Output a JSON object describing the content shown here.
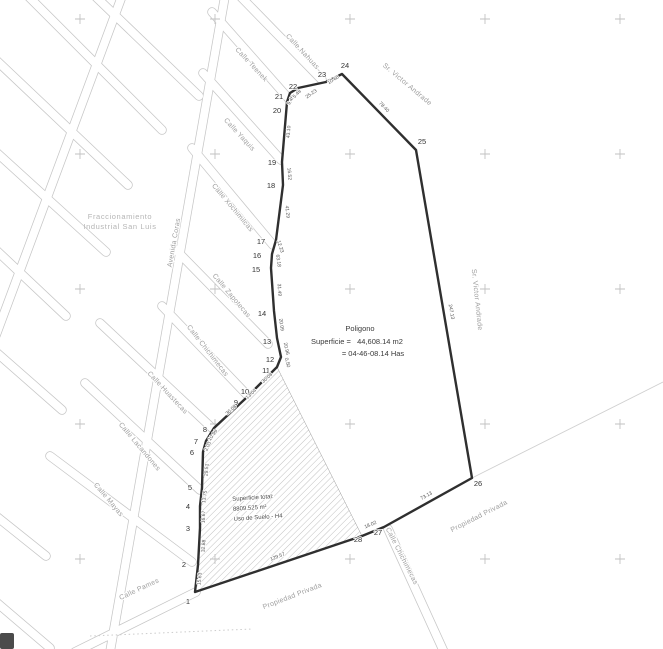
{
  "map": {
    "region_label": {
      "line1": "Fraccionamiento",
      "line2": "Industrial San Luis"
    },
    "center_note": {
      "title": "Poligono",
      "line2": "Superficie =   44,608.14 m2",
      "line3": "= 04-46-08.14 Has"
    },
    "hatch_note": {
      "line1": "Superficie total:",
      "line2": "8809.525 m²",
      "line3": "Uso de Suelo - H4"
    },
    "colors": {
      "boundary": "#2f2f2f",
      "streets": "#c6c6c6",
      "labels": "#9e9e9e",
      "crosses": "#c2c2c2"
    },
    "streets": [
      {
        "label": "Calle Nahuas",
        "x": 301,
        "y": 53,
        "rot": 47
      },
      {
        "label": "Calle Teenek",
        "x": 250,
        "y": 66,
        "rot": 47
      },
      {
        "label": "Calle Yaquis",
        "x": 238,
        "y": 136,
        "rot": 47
      },
      {
        "label": "Calle Xochimilcas",
        "x": 231,
        "y": 209,
        "rot": 50
      },
      {
        "label": "Calle Zapotecas",
        "x": 230,
        "y": 297,
        "rot": 50
      },
      {
        "label": "Calle Chichimecas",
        "x": 206,
        "y": 352,
        "rot": 52
      },
      {
        "label": "Calle Huastecas",
        "x": 166,
        "y": 394,
        "rot": 47
      },
      {
        "label": "Calle Lacandones",
        "x": 138,
        "y": 448,
        "rot": 50
      },
      {
        "label": "Calle Mayas",
        "x": 107,
        "y": 501,
        "rot": 50
      },
      {
        "label": "Calle Pames",
        "x": 140,
        "y": 591,
        "rot": -25
      },
      {
        "label": "Avenida Coras",
        "x": 176,
        "y": 243,
        "rot": -80
      },
      {
        "label": "Calle Chichimecas",
        "x": 400,
        "y": 557,
        "rot": 63
      }
    ],
    "annotations": [
      {
        "label": "Sr. Victor Andrade",
        "x": 406,
        "y": 86,
        "rot": 40
      },
      {
        "label": "Sr. Victor Andrade",
        "x": 475,
        "y": 300,
        "rot": 84
      },
      {
        "label": "Propiedad Privada",
        "x": 480,
        "y": 518,
        "rot": -27
      },
      {
        "label": "Propiedad Privada",
        "x": 293,
        "y": 598,
        "rot": -21
      }
    ],
    "polygon": {
      "vertices": [
        {
          "n": "1",
          "x": 188,
          "y": 604
        },
        {
          "n": "2",
          "x": 184,
          "y": 567
        },
        {
          "n": "3",
          "x": 188,
          "y": 531
        },
        {
          "n": "4",
          "x": 188,
          "y": 509
        },
        {
          "n": "5",
          "x": 190,
          "y": 490
        },
        {
          "n": "6",
          "x": 192,
          "y": 455
        },
        {
          "n": "7",
          "x": 196,
          "y": 444
        },
        {
          "n": "8",
          "x": 205,
          "y": 432
        },
        {
          "n": "9",
          "x": 236,
          "y": 405
        },
        {
          "n": "10",
          "x": 245,
          "y": 394
        },
        {
          "n": "11",
          "x": 266,
          "y": 373
        },
        {
          "n": "12",
          "x": 270,
          "y": 362
        },
        {
          "n": "13",
          "x": 267,
          "y": 344
        },
        {
          "n": "14",
          "x": 262,
          "y": 316
        },
        {
          "n": "15",
          "x": 256,
          "y": 272
        },
        {
          "n": "16",
          "x": 257,
          "y": 258
        },
        {
          "n": "17",
          "x": 261,
          "y": 244
        },
        {
          "n": "18",
          "x": 271,
          "y": 188
        },
        {
          "n": "19",
          "x": 272,
          "y": 165
        },
        {
          "n": "20",
          "x": 277,
          "y": 113
        },
        {
          "n": "21",
          "x": 279,
          "y": 99
        },
        {
          "n": "22",
          "x": 293,
          "y": 89
        },
        {
          "n": "23",
          "x": 322,
          "y": 77
        },
        {
          "n": "24",
          "x": 345,
          "y": 68
        },
        {
          "n": "25",
          "x": 422,
          "y": 144
        },
        {
          "n": "26",
          "x": 478,
          "y": 486
        },
        {
          "n": "27",
          "x": 378,
          "y": 535
        },
        {
          "n": "28",
          "x": 358,
          "y": 542
        }
      ],
      "edge_labels": [
        {
          "t": "15.63",
          "x": 201,
          "y": 579,
          "rot": -84
        },
        {
          "t": "32.88",
          "x": 205,
          "y": 546,
          "rot": -86
        },
        {
          "t": "16.67",
          "x": 205,
          "y": 517,
          "rot": -88
        },
        {
          "t": "13.75",
          "x": 206,
          "y": 497,
          "rot": -82
        },
        {
          "t": "29.51",
          "x": 208,
          "y": 470,
          "rot": -85
        },
        {
          "t": "2.03",
          "x": 209,
          "y": 447,
          "rot": -65
        },
        {
          "t": "10.99",
          "x": 214,
          "y": 436,
          "rot": -55
        },
        {
          "t": "30.08",
          "x": 232,
          "y": 411,
          "rot": -43
        },
        {
          "t": "13.04",
          "x": 252,
          "y": 395,
          "rot": -43
        },
        {
          "t": "30.08",
          "x": 268,
          "y": 379,
          "rot": -43
        },
        {
          "t": "0.50",
          "x": 286,
          "y": 363,
          "rot": 75
        },
        {
          "t": "20.96",
          "x": 285,
          "y": 349,
          "rot": 78
        },
        {
          "t": "20.09",
          "x": 280,
          "y": 325,
          "rot": 82
        },
        {
          "t": "31.49",
          "x": 278,
          "y": 290,
          "rot": 86
        },
        {
          "t": "63.18",
          "x": 277,
          "y": 261,
          "rot": 82
        },
        {
          "t": "12.23",
          "x": 279,
          "y": 247,
          "rot": 72
        },
        {
          "t": "41.29",
          "x": 286,
          "y": 212,
          "rot": 84
        },
        {
          "t": "16.52",
          "x": 288,
          "y": 174,
          "rot": 85
        },
        {
          "t": "43.10",
          "x": 290,
          "y": 132,
          "rot": -85
        },
        {
          "t": "9.45",
          "x": 292,
          "y": 101,
          "rot": -60
        },
        {
          "t": "5.48",
          "x": 298,
          "y": 95,
          "rot": -45
        },
        {
          "t": "25.23",
          "x": 312,
          "y": 95,
          "rot": -35
        },
        {
          "t": "10.68",
          "x": 334,
          "y": 81,
          "rot": -33
        },
        {
          "t": "78.40",
          "x": 383,
          "y": 108,
          "rot": 46
        },
        {
          "t": "247.13",
          "x": 450,
          "y": 312,
          "rot": 80
        },
        {
          "t": "73.13",
          "x": 427,
          "y": 497,
          "rot": -29
        },
        {
          "t": "18.02",
          "x": 371,
          "y": 526,
          "rot": -23
        },
        {
          "t": "129.57",
          "x": 278,
          "y": 558,
          "rot": -21
        }
      ]
    }
  }
}
